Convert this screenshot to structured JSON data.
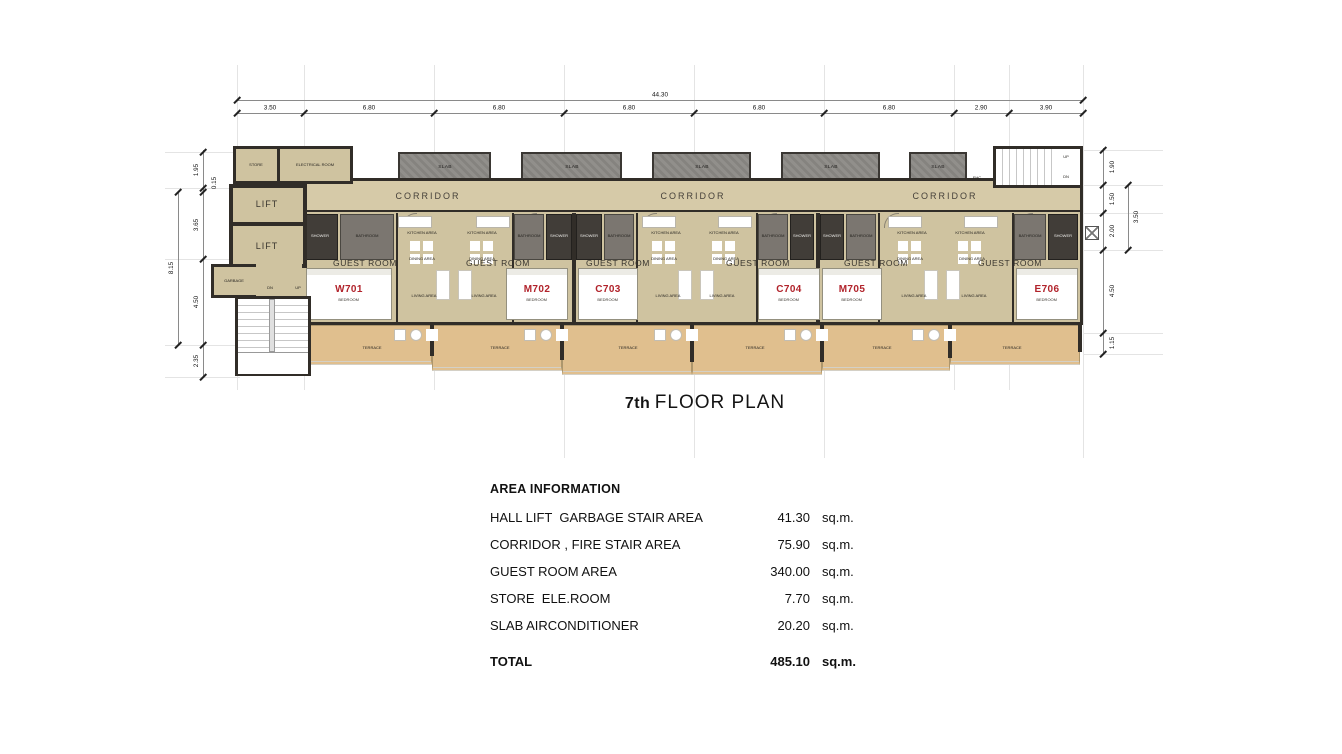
{
  "plan": {
    "title_floor": "7th",
    "title_rest": "FLOOR PLAN",
    "dims": {
      "top_total": "44.30",
      "top": [
        "3.50",
        "6.80",
        "6.80",
        "6.80",
        "6.80",
        "6.80",
        "2.90",
        "3.90"
      ],
      "left_total": "8.15",
      "left": [
        "1.95",
        "0.15",
        "3.65",
        "4.50",
        "2.35"
      ],
      "right_total": "3.50",
      "right": [
        "1.90",
        "1.50",
        "2.00",
        "4.50",
        "1.15"
      ]
    },
    "labels": {
      "corridor": "CORRIDOR",
      "slab": "SLAB",
      "guest_room": "GUEST ROOM",
      "terrace": "TERRACE",
      "kitchen": "KITCHEN AREA",
      "dining": "DINING AREA",
      "living": "LIVING AREA",
      "shower": "SHOWER",
      "bathroom": "BATHROOM",
      "bedroom": "BEDROOM",
      "store": "STORE",
      "electrical_room": "ELECTRICAL ROOM",
      "lift": "LIFT",
      "garbage": "GARBAGE",
      "up": "UP",
      "dn": "DN",
      "fhc": "FHC"
    },
    "units": [
      {
        "number": "W701"
      },
      {
        "number": "M702"
      },
      {
        "number": "C703"
      },
      {
        "number": "C704"
      },
      {
        "number": "M705"
      },
      {
        "number": "E706"
      }
    ]
  },
  "area_table": {
    "title": "AREA INFORMATION",
    "rows": [
      {
        "label": "HALL LIFT  GARBAGE STAIR AREA",
        "value": "41.30",
        "unit": "sq.m."
      },
      {
        "label": "CORRIDOR , FIRE STAIR AREA",
        "value": "75.90",
        "unit": "sq.m."
      },
      {
        "label": "GUEST ROOM AREA",
        "value": "340.00",
        "unit": "sq.m."
      },
      {
        "label": "STORE  ELE.ROOM",
        "value": "7.70",
        "unit": "sq.m."
      },
      {
        "label": "SLAB AIRCONDITIONER",
        "value": "20.20",
        "unit": "sq.m."
      }
    ],
    "total_row": {
      "label": "TOTAL",
      "value": "485.10",
      "unit": "sq.m."
    }
  },
  "colors": {
    "floor_tan": "#cfc3a0",
    "corridor_tan": "#d6caa8",
    "terrace_tan": "#e0bf8e",
    "wall_dark": "#312d28",
    "slab_gray": "#8b8985",
    "room_number_red": "#b1232b"
  }
}
